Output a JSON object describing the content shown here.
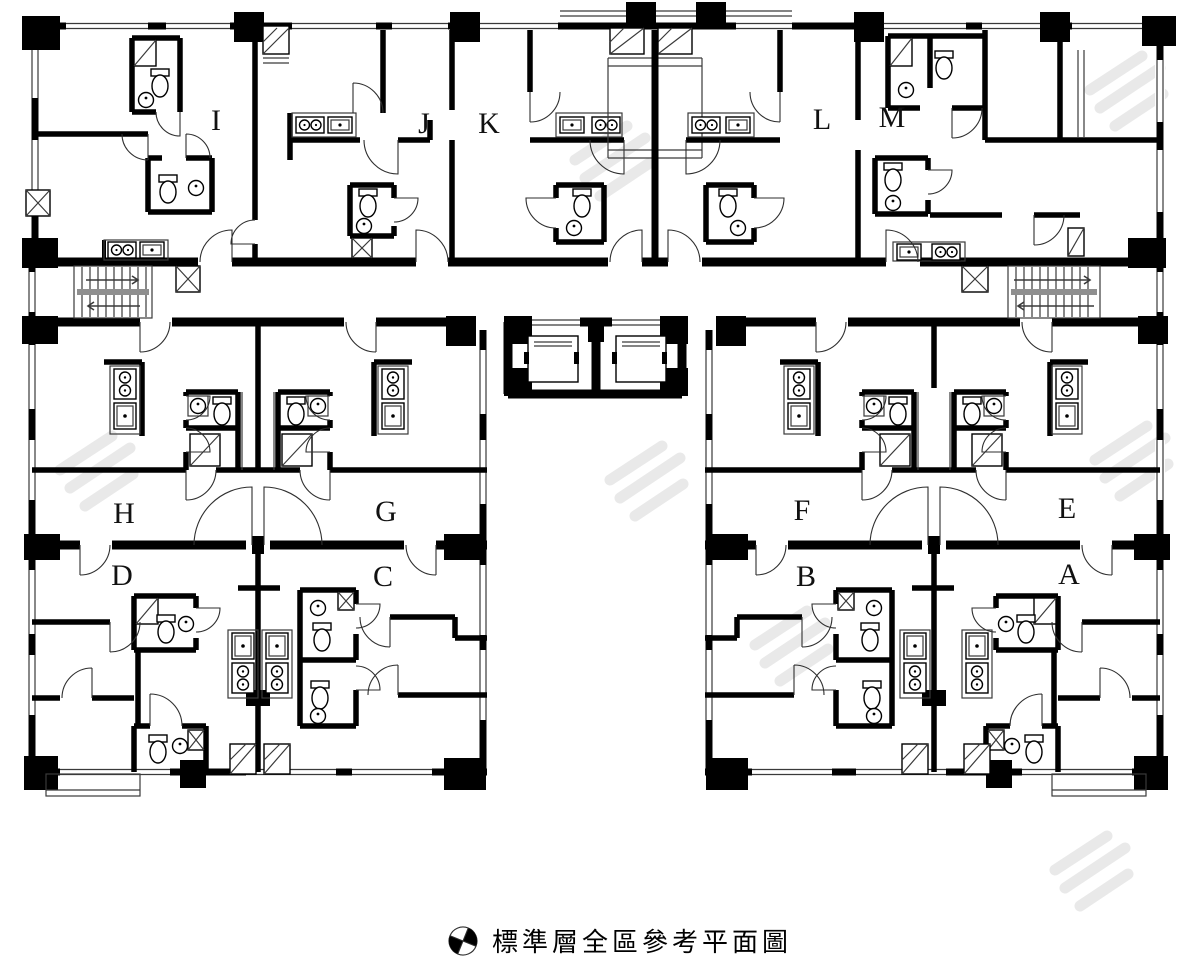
{
  "caption": {
    "text": "標準層全區參考平面圖",
    "icon": "north-compass-icon"
  },
  "units": [
    {
      "id": "unit-i",
      "label": "I"
    },
    {
      "id": "unit-j",
      "label": "J"
    },
    {
      "id": "unit-k",
      "label": "K"
    },
    {
      "id": "unit-l",
      "label": "L"
    },
    {
      "id": "unit-m",
      "label": "M"
    },
    {
      "id": "unit-h",
      "label": "H"
    },
    {
      "id": "unit-g",
      "label": "G"
    },
    {
      "id": "unit-f",
      "label": "F"
    },
    {
      "id": "unit-e",
      "label": "E"
    },
    {
      "id": "unit-d",
      "label": "D"
    },
    {
      "id": "unit-c",
      "label": "C"
    },
    {
      "id": "unit-b",
      "label": "B"
    },
    {
      "id": "unit-a",
      "label": "A"
    }
  ],
  "colors": {
    "wall": "#000000",
    "thin_line": "#3a3a3a",
    "stair_landing": "#8f8f8f",
    "watermark": "#e9e9e9",
    "background": "#ffffff",
    "label": "#111111"
  }
}
